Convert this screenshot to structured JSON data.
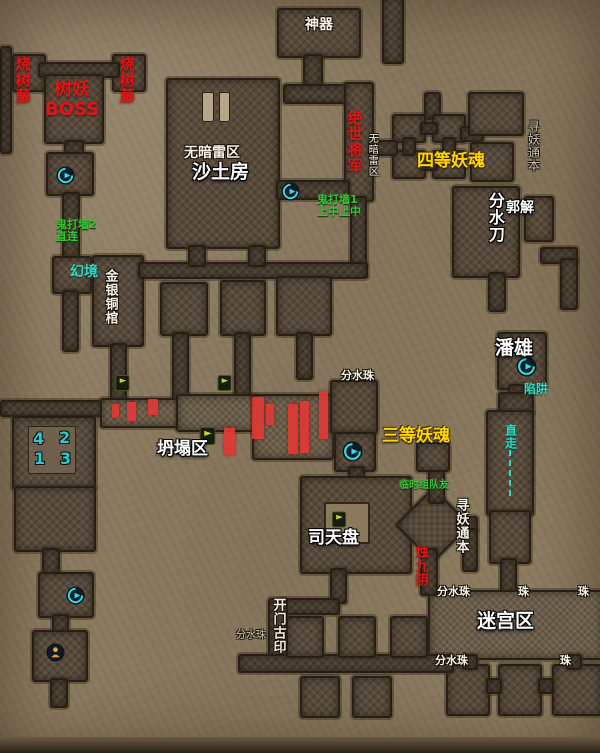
{
  "labels": {
    "artifact": "神器",
    "tree_boss": "树妖\nBOSS",
    "burn_vine_left": "烧树藤",
    "burn_vine_right": "烧树藤",
    "no_mine_zone": "无暗雷区",
    "sand_room": "沙土房",
    "peerless_general": "绝世将军",
    "no_mine_zone_small": "无暗雷区",
    "ghost_wall_1": "鬼打墙1\n上中上中",
    "ghost_wall_2": "鬼打墙2\n直连",
    "illusion": "幻境",
    "gold_silver_coffin": "金银铜棺",
    "grade4_soul": "四等妖魂",
    "seek_demon_book_top": "寻妖通本",
    "water_blade": "分水刀",
    "guo_jie": "郭解",
    "pan_xiong": "潘雄",
    "trap": "陷阱",
    "go_straight": "直走",
    "water_pearl_mid": "分水珠",
    "grade3_soul": "三等妖魂",
    "collapse_zone": "坍塌区",
    "num_4": "4",
    "num_2": "2",
    "num_1": "1",
    "num_3": "3",
    "temp_teammate": "临时组队友",
    "sky_plate": "司天盘",
    "seek_demon_book_bottom": "寻妖通本",
    "zhu_jiuyin": "烛九阴",
    "water_pearl_maze_top": "分水珠",
    "pearl_a": "珠",
    "pearl_b": "珠",
    "water_pearl_maze_bottom": "分水珠",
    "pearl_c": "珠",
    "maze_zone": "迷宫区",
    "open_door_seal": "开门古印",
    "water_pearl_bottom": "分水珠"
  },
  "colors": {
    "label_red": "#e31414",
    "label_yellow": "#ffd400",
    "label_green": "#35c435",
    "label_teal": "#2fd9c4",
    "label_cyan": "#2cc9d4",
    "label_white": "#f5f1e6",
    "label_gray": "#c9c2b2",
    "danger_marker": "#df3a34",
    "portal_cyan": "#38dce2",
    "marker_yellow": "#ccd22c",
    "exit_orange": "#e8a13c",
    "room_fill": "#584a3a",
    "background_tan": "#8d7c60"
  },
  "icons": {
    "portal": "portal-swirl-icon",
    "quest": "quest-flag-icon",
    "exit": "npc-exit-icon"
  }
}
